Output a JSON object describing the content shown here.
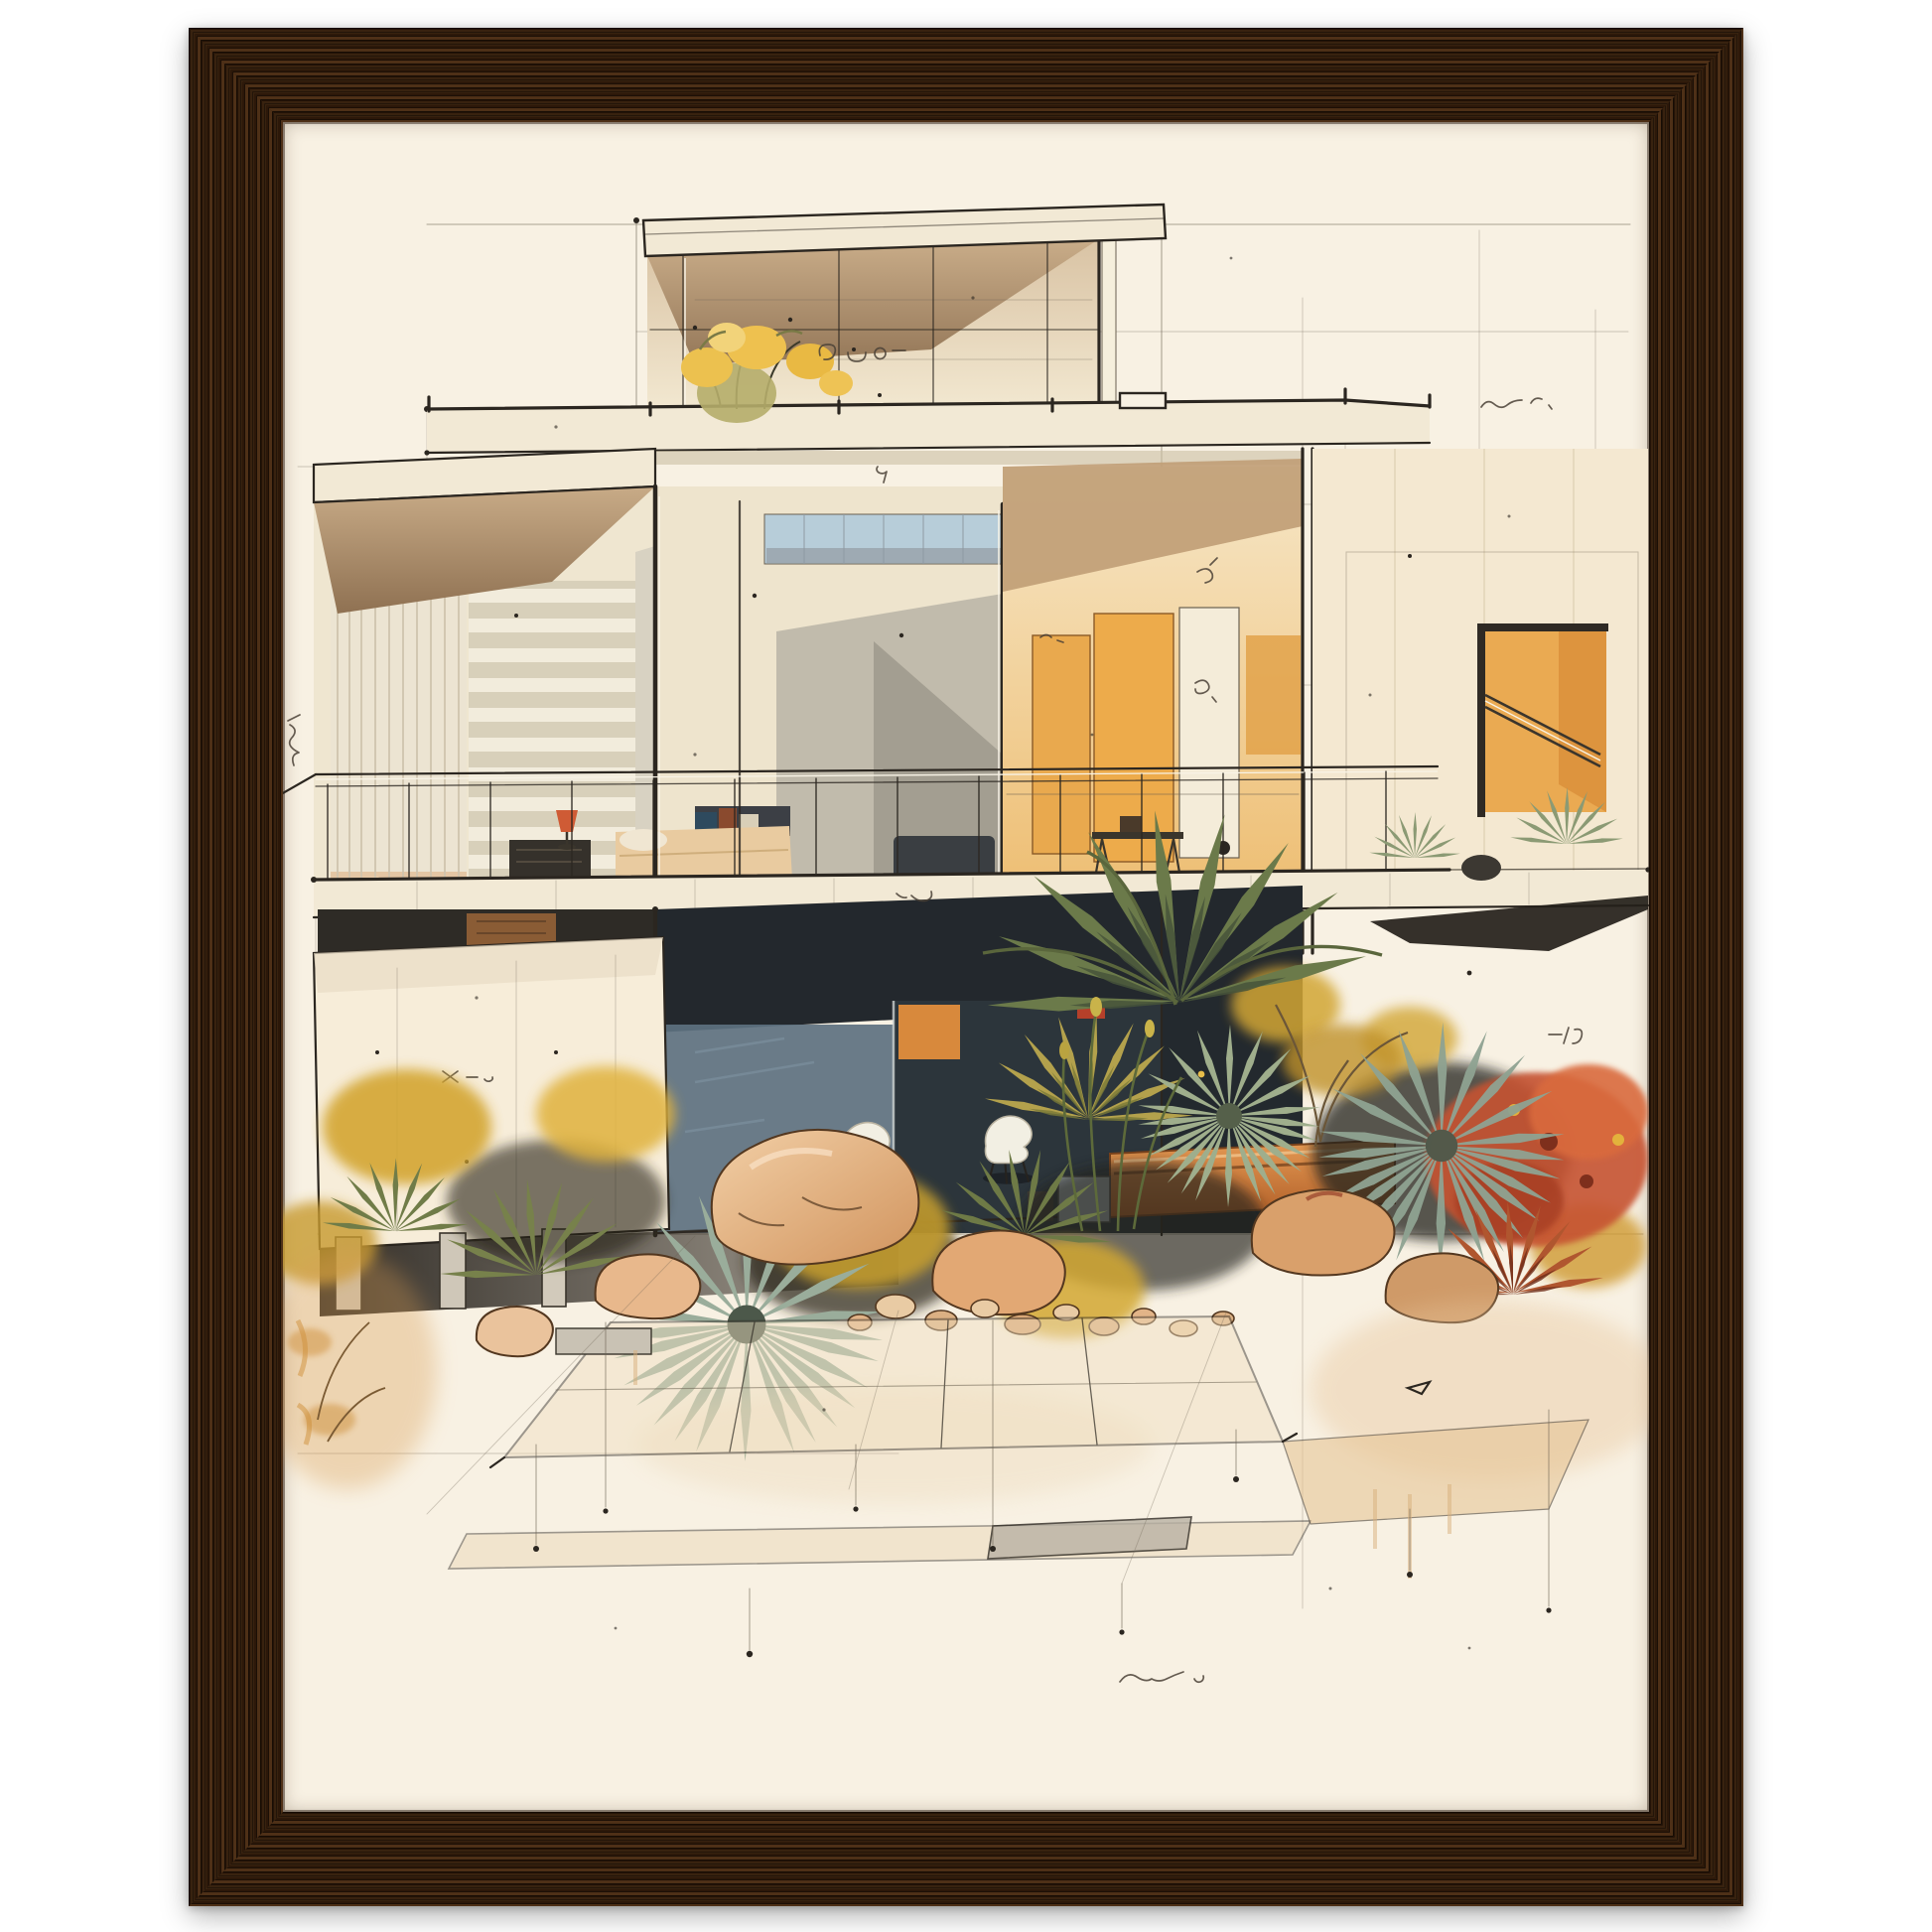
{
  "image_type": "framed-art-print-product-photo",
  "frame": {
    "material_look": "dark walnut wood, vertical grain",
    "thickness_px": 95,
    "wood_dark": "#241307",
    "wood_mid": "#38220f",
    "wood_light": "#4e3017"
  },
  "paper": {
    "color": "#f8f1e3"
  },
  "palette": {
    "paper": "#f8f1e3",
    "ink": "#2b2620",
    "pencil": "#6a6051",
    "slab": "#f2e9d5",
    "curtain": "#ece4d2",
    "louver": "#e9e1cd",
    "glass_sky": "#b7cdd9",
    "glass_blue": "#5d7180",
    "glass_dark": "#23282d",
    "warm_wall": "#f4e8d1",
    "orange_panel": "#e9a94e",
    "amber_window": "#eaaa52",
    "olive": "#6b7a4a",
    "olive_dark": "#47543a",
    "sage": "#9fae8c",
    "teal": "#8fa392",
    "moss": "#77814b",
    "ochre": "#d3a42f",
    "rust": "#c65233",
    "rust_dark": "#7e2f1c",
    "rock_hi": "#f2cfa6",
    "rock_lo": "#d1945e",
    "rock_line": "#53371f",
    "shadow": "#221d18",
    "chair": "#f2efe3",
    "bed": "#e9cba0",
    "lamp": "#cf5b35",
    "wood_dark": "#241307",
    "wood_mid": "#38220f",
    "wood_light": "#4e3017"
  },
  "artwork": {
    "subject": "watercolor and ink concept sketch of a two-storey modernist glass house on pilotis with desert garden",
    "elements": [
      "penthouse roof slab",
      "roof-deck flowers",
      "glass curtain wall",
      "bedroom with bed and lamp",
      "orange kitchen interior",
      "balcony railing",
      "cream wall panel on pilotis",
      "white shell chairs",
      "orange planter box",
      "palm and yucca fans",
      "ochre bushes",
      "rust-red bush",
      "rocks and pebbles",
      "paved path",
      "construction pencil lines"
    ]
  },
  "annotations": [
    {
      "id": "note-top-right",
      "text": "(illegible handwriting)"
    },
    {
      "id": "note-roof",
      "text": "(illegible handwriting)"
    },
    {
      "id": "note-left-edge",
      "text": "(illegible handwriting)"
    },
    {
      "id": "note-wall-panel",
      "text": "(illegible handwriting)"
    },
    {
      "id": "note-kitchen-wall",
      "text": "(illegible handwriting)"
    },
    {
      "id": "note-bottom-center",
      "text": "(illegible handwriting)"
    },
    {
      "id": "note-bottom-right",
      "text": "(illegible handwriting)"
    }
  ]
}
